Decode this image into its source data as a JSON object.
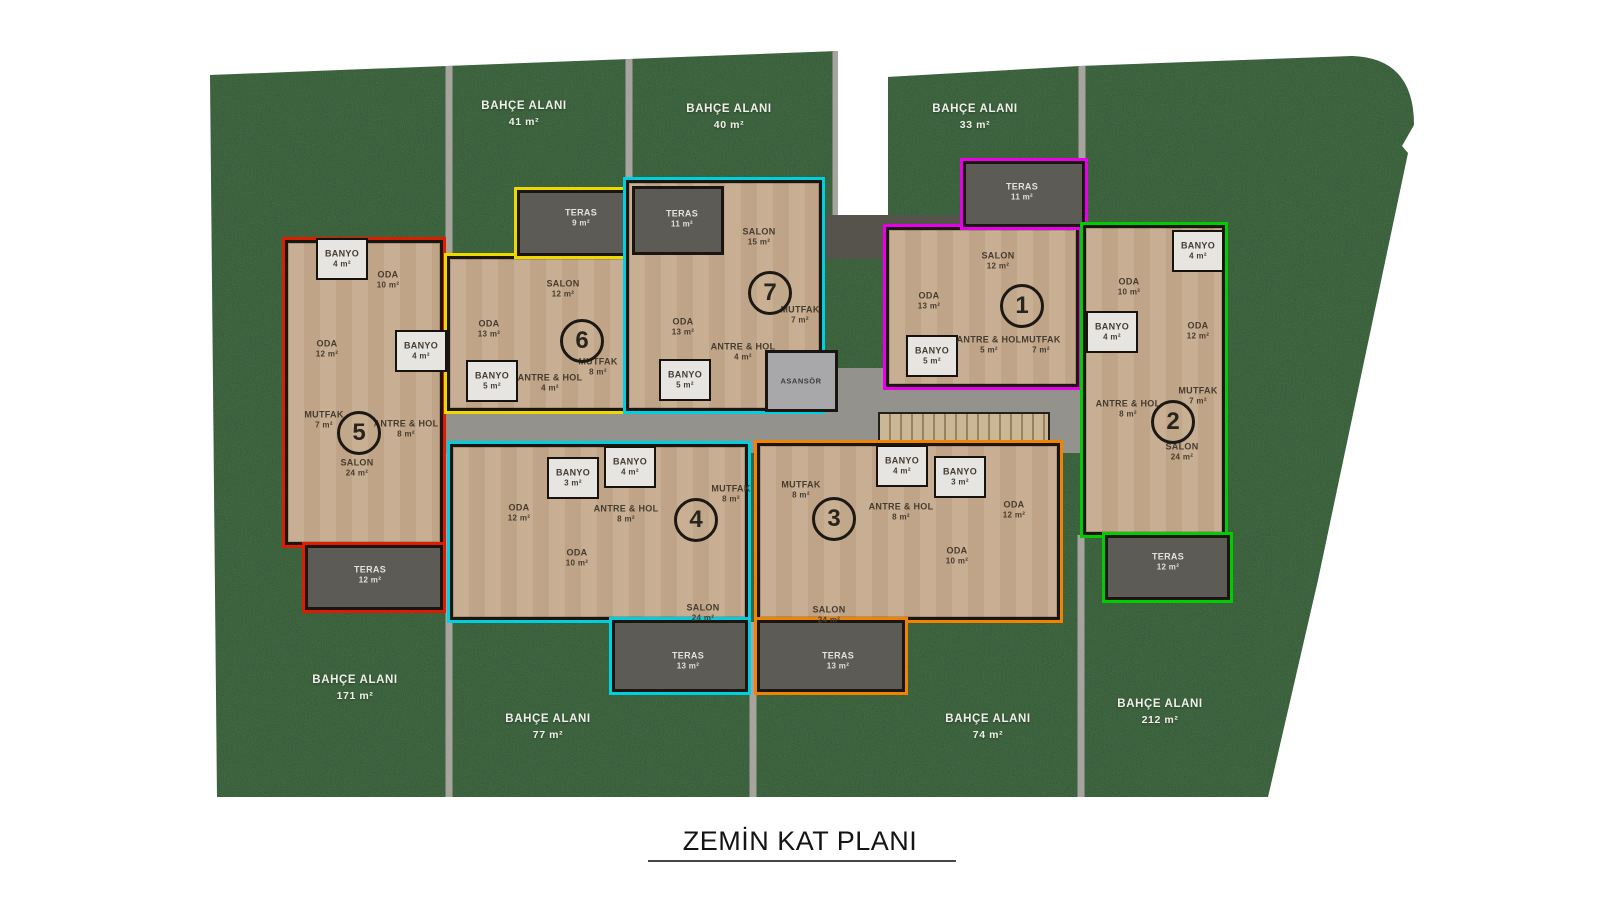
{
  "title": "ZEMİN KAT PLANI",
  "elevator": {
    "label": "ASANSÖR"
  },
  "gardens": [
    {
      "label": "BAHÇE ALANI",
      "area": "41 m²",
      "x": 524,
      "y": 114
    },
    {
      "label": "BAHÇE ALANI",
      "area": "40 m²",
      "x": 729,
      "y": 117
    },
    {
      "label": "BAHÇE ALANI",
      "area": "33 m²",
      "x": 975,
      "y": 117
    },
    {
      "label": "BAHÇE ALANI",
      "area": "171 m²",
      "x": 355,
      "y": 688
    },
    {
      "label": "BAHÇE ALANI",
      "area": "77 m²",
      "x": 548,
      "y": 727
    },
    {
      "label": "BAHÇE ALANI",
      "area": "74 m²",
      "x": 988,
      "y": 727
    },
    {
      "label": "BAHÇE ALANI",
      "area": "212 m²",
      "x": 1160,
      "y": 712
    }
  ],
  "units": [
    {
      "number": "1",
      "color": "#e800e8",
      "main": {
        "x": 886,
        "y": 227,
        "w": 193,
        "h": 160
      },
      "terrace": {
        "x": 963,
        "y": 161,
        "w": 122,
        "h": 66,
        "label": "TERAS",
        "area": "11 m²",
        "lx": 1022,
        "ly": 192,
        "outlined": true
      },
      "badge": {
        "x": 1022,
        "y": 306
      },
      "rooms": [
        {
          "name": "SALON",
          "area": "12 m²",
          "x": 998,
          "y": 261
        },
        {
          "name": "ODA",
          "area": "13 m²",
          "x": 929,
          "y": 301
        },
        {
          "name": "ANTRE & HOL",
          "area": "5 m²",
          "x": 989,
          "y": 345
        },
        {
          "name": "MUTFAK",
          "area": "7 m²",
          "x": 1041,
          "y": 345
        },
        {
          "name": "BANYO",
          "area": "5 m²",
          "x": 932,
          "y": 356,
          "bath": true
        }
      ]
    },
    {
      "number": "2",
      "color": "#00cc00",
      "main": {
        "x": 1083,
        "y": 225,
        "w": 142,
        "h": 310
      },
      "terrace": {
        "x": 1105,
        "y": 535,
        "w": 125,
        "h": 65,
        "label": "TERAS",
        "area": "12 m²",
        "lx": 1168,
        "ly": 562,
        "outlined": true
      },
      "badge": {
        "x": 1173,
        "y": 422
      },
      "rooms": [
        {
          "name": "BANYO",
          "area": "4 m²",
          "x": 1198,
          "y": 251,
          "bath": true
        },
        {
          "name": "ODA",
          "area": "10 m²",
          "x": 1129,
          "y": 287
        },
        {
          "name": "BANYO",
          "area": "4 m²",
          "x": 1112,
          "y": 332,
          "bath": true
        },
        {
          "name": "ODA",
          "area": "12 m²",
          "x": 1198,
          "y": 331
        },
        {
          "name": "MUTFAK",
          "area": "7 m²",
          "x": 1198,
          "y": 396
        },
        {
          "name": "ANTRE & HOL",
          "area": "8 m²",
          "x": 1128,
          "y": 409
        },
        {
          "name": "SALON",
          "area": "24 m²",
          "x": 1182,
          "y": 452
        }
      ]
    },
    {
      "number": "3",
      "color": "#f08300",
      "main": {
        "x": 757,
        "y": 443,
        "w": 303,
        "h": 177
      },
      "terrace": {
        "x": 757,
        "y": 620,
        "w": 148,
        "h": 72,
        "label": "TERAS",
        "area": "13 m²",
        "lx": 838,
        "ly": 661,
        "outlined": true
      },
      "badge": {
        "x": 834,
        "y": 519
      },
      "rooms": [
        {
          "name": "MUTFAK",
          "area": "8 m²",
          "x": 801,
          "y": 490
        },
        {
          "name": "BANYO",
          "area": "4 m²",
          "x": 902,
          "y": 466,
          "bath": true
        },
        {
          "name": "BANYO",
          "area": "3 m²",
          "x": 960,
          "y": 477,
          "bath": true
        },
        {
          "name": "ANTRE & HOL",
          "area": "8 m²",
          "x": 901,
          "y": 512
        },
        {
          "name": "ODA",
          "area": "12 m²",
          "x": 1014,
          "y": 510
        },
        {
          "name": "ODA",
          "area": "10 m²",
          "x": 957,
          "y": 556
        },
        {
          "name": "SALON",
          "area": "24 m²",
          "x": 829,
          "y": 615
        }
      ]
    },
    {
      "number": "4",
      "color": "#00cfdf",
      "main": {
        "x": 450,
        "y": 444,
        "w": 298,
        "h": 176
      },
      "terrace": {
        "x": 612,
        "y": 620,
        "w": 136,
        "h": 72,
        "label": "TERAS",
        "area": "13 m²",
        "lx": 688,
        "ly": 661,
        "outlined": true
      },
      "badge": {
        "x": 696,
        "y": 520
      },
      "rooms": [
        {
          "name": "ODA",
          "area": "12 m²",
          "x": 519,
          "y": 513
        },
        {
          "name": "BANYO",
          "area": "3 m²",
          "x": 573,
          "y": 478,
          "bath": true
        },
        {
          "name": "BANYO",
          "area": "4 m²",
          "x": 630,
          "y": 467,
          "bath": true
        },
        {
          "name": "ANTRE & HOL",
          "area": "8 m²",
          "x": 626,
          "y": 514
        },
        {
          "name": "MUTFAK",
          "area": "8 m²",
          "x": 731,
          "y": 494
        },
        {
          "name": "ODA",
          "area": "10 m²",
          "x": 577,
          "y": 558
        },
        {
          "name": "SALON",
          "area": "24 m²",
          "x": 703,
          "y": 613
        }
      ]
    },
    {
      "number": "5",
      "color": "#dd1c00",
      "main": {
        "x": 285,
        "y": 240,
        "w": 158,
        "h": 305
      },
      "terrace": {
        "x": 305,
        "y": 545,
        "w": 138,
        "h": 65,
        "label": "TERAS",
        "area": "12 m²",
        "lx": 370,
        "ly": 575,
        "outlined": true
      },
      "badge": {
        "x": 359,
        "y": 433
      },
      "rooms": [
        {
          "name": "BANYO",
          "area": "4 m²",
          "x": 342,
          "y": 259,
          "bath": true
        },
        {
          "name": "ODA",
          "area": "10 m²",
          "x": 388,
          "y": 280
        },
        {
          "name": "ODA",
          "area": "12 m²",
          "x": 327,
          "y": 349
        },
        {
          "name": "BANYO",
          "area": "4 m²",
          "x": 421,
          "y": 351,
          "bath": true
        },
        {
          "name": "MUTFAK",
          "area": "7 m²",
          "x": 324,
          "y": 420
        },
        {
          "name": "ANTRE & HOL",
          "area": "8 m²",
          "x": 406,
          "y": 429
        },
        {
          "name": "SALON",
          "area": "24 m²",
          "x": 357,
          "y": 468
        }
      ]
    },
    {
      "number": "6",
      "color": "#efd700",
      "main": {
        "x": 447,
        "y": 256,
        "w": 183,
        "h": 155
      },
      "terrace": {
        "x": 517,
        "y": 190,
        "w": 111,
        "h": 66,
        "label": "TERAS",
        "area": "9 m²",
        "lx": 581,
        "ly": 218,
        "outlined": true
      },
      "badge": {
        "x": 582,
        "y": 341
      },
      "rooms": [
        {
          "name": "SALON",
          "area": "12 m²",
          "x": 563,
          "y": 289
        },
        {
          "name": "ODA",
          "area": "13 m²",
          "x": 489,
          "y": 329
        },
        {
          "name": "BANYO",
          "area": "5 m²",
          "x": 492,
          "y": 381,
          "bath": true
        },
        {
          "name": "ANTRE & HOL",
          "area": "4 m²",
          "x": 550,
          "y": 383
        },
        {
          "name": "MUTFAK",
          "area": "8 m²",
          "x": 598,
          "y": 367
        }
      ]
    },
    {
      "number": "7",
      "color": "#00cfdf",
      "main": {
        "x": 626,
        "y": 180,
        "w": 196,
        "h": 231
      },
      "terrace": {
        "x": 632,
        "y": 186,
        "w": 92,
        "h": 69,
        "label": "TERAS",
        "area": "11 m²",
        "lx": 682,
        "ly": 219,
        "outlined": false
      },
      "badge": {
        "x": 770,
        "y": 293
      },
      "rooms": [
        {
          "name": "SALON",
          "area": "15 m²",
          "x": 759,
          "y": 237
        },
        {
          "name": "ODA",
          "area": "13 m²",
          "x": 683,
          "y": 327
        },
        {
          "name": "MUTFAK",
          "area": "7 m²",
          "x": 800,
          "y": 315
        },
        {
          "name": "ANTRE & HOL",
          "area": "4 m²",
          "x": 743,
          "y": 352
        },
        {
          "name": "BANYO",
          "area": "5 m²",
          "x": 685,
          "y": 380,
          "bath": true
        }
      ]
    }
  ]
}
